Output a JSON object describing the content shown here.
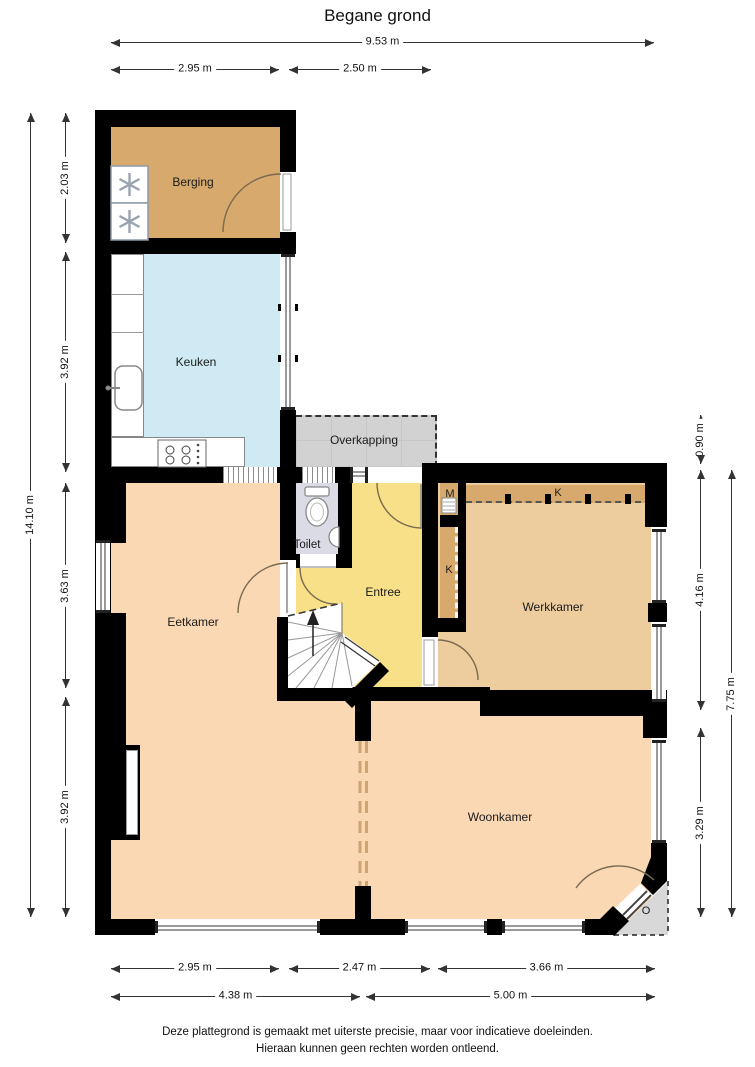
{
  "title": "Begane grond",
  "rooms": {
    "berging": "Berging",
    "keuken": "Keuken",
    "overkapping": "Overkapping",
    "toilet": "Toilet",
    "entree": "Entree",
    "werkkamer": "Werkkamer",
    "eetkamer": "Eetkamer",
    "woonkamer": "Woonkamer"
  },
  "labels": {
    "meterkast": "M",
    "kast_werkkamer": "K",
    "kast_hal": "K",
    "portiek": "O"
  },
  "dimensions": {
    "top": {
      "total": "9.53 m",
      "berging": "2.95 m",
      "entree": "2.50 m"
    },
    "left": {
      "total": "14.10 m",
      "berging": "2.03 m",
      "keuken": "3.92 m",
      "eetkamer": "3.63 m",
      "woonkamer": "3.92 m"
    },
    "right": {
      "overkapping": "0.90 m",
      "werkkamer": "4.16 m",
      "woonkamer": "3.29 m",
      "total": "7.75 m"
    },
    "bottom": {
      "eetkamer": "2.95 m",
      "midden": "2.47 m",
      "woonkamer": "3.66 m",
      "links_totaal": "4.38 m",
      "rechts_totaal": "5.00 m"
    }
  },
  "disclaimer": {
    "line1": "Deze plattegrond is gemaakt met uiterste precisie, maar voor indicatieve doeleinden.",
    "line2": "Hieraan kunnen geen rechten worden ontleend."
  },
  "colors": {
    "wall": "#000000",
    "berging_kast": "#d7a96c",
    "werkkamer": "#edcd9e",
    "keuken": "#cfeaf2",
    "entree": "#f8e089",
    "eetkamer_woonkamer": "#fad8b3",
    "toilet": "#dadbe5",
    "overkapping": "#d2d2d2",
    "portiek": "#d8d8d8",
    "window_frame": "#9a9a9a"
  }
}
